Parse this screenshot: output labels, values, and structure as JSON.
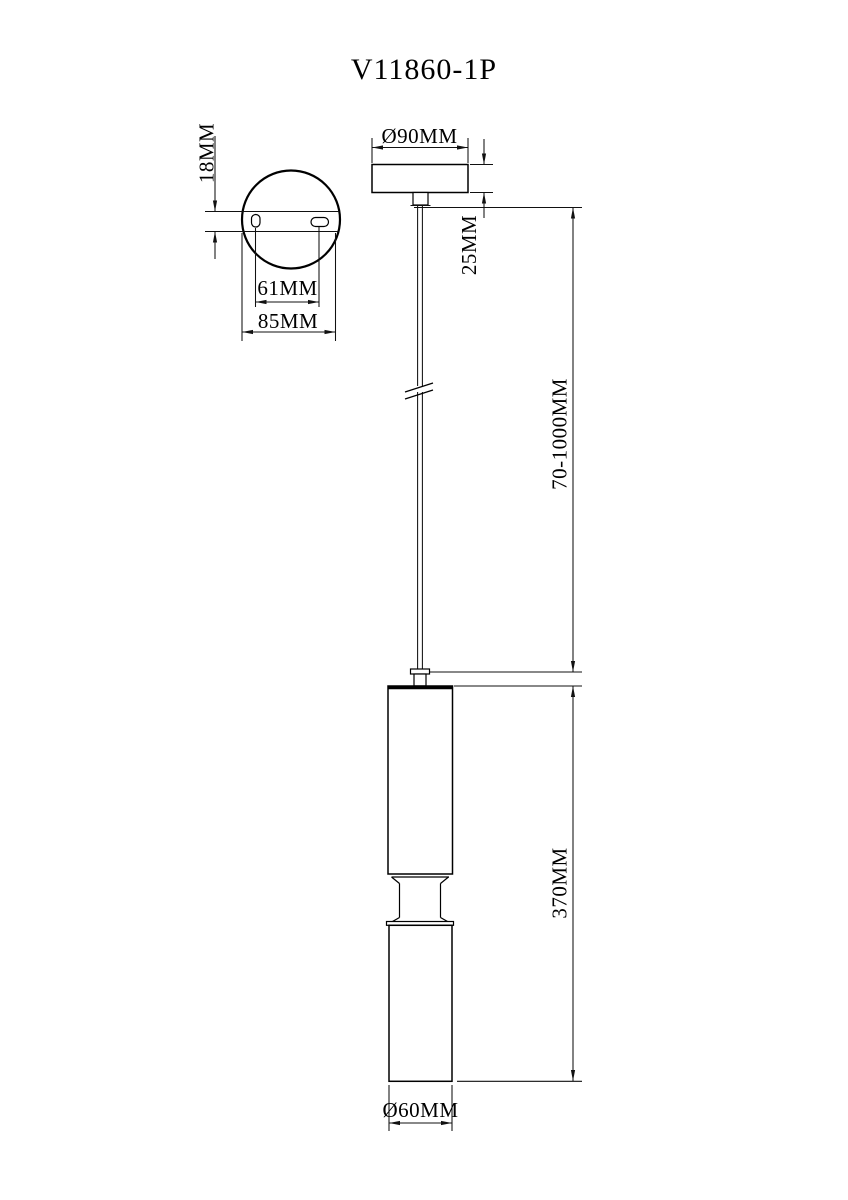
{
  "title": "V11860-1P",
  "colors": {
    "line": "#000000",
    "background": "#ffffff"
  },
  "top_view": {
    "plate_thickness": "18MM",
    "hole_spacing": "61MM",
    "plate_width": "85MM"
  },
  "front_view": {
    "canopy_diameter": "Ø90MM",
    "canopy_height": "25MM",
    "suspension_range": "70-1000MM",
    "fixture_height": "370MM",
    "shade_diameter": "Ø60MM"
  }
}
